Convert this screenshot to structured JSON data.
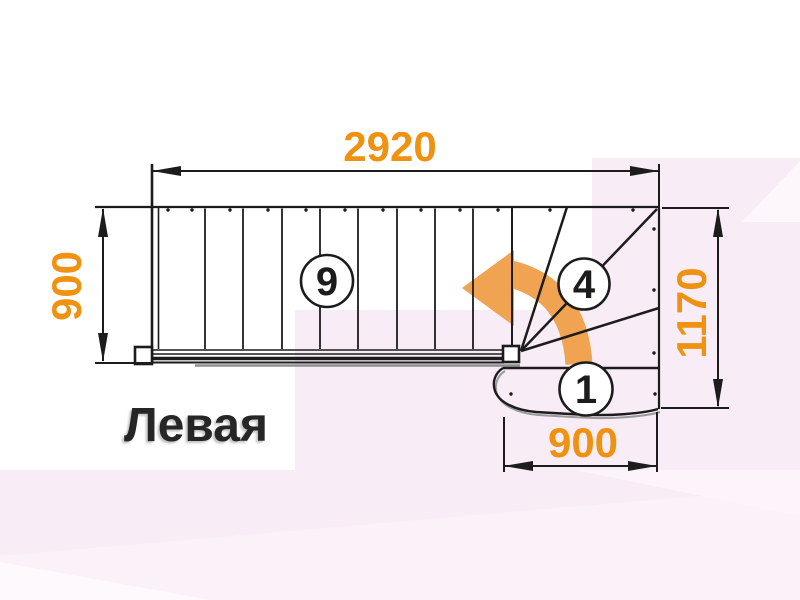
{
  "diagram": {
    "orientation_label": "Левая",
    "dimensions": {
      "top_width": "2920",
      "left_height": "900",
      "right_height": "1170",
      "bottom_width": "900"
    },
    "step_labels": {
      "straight_steps": "9",
      "winder_step": "4",
      "first_step": "1"
    },
    "colors": {
      "dimension_text": "#EF9211",
      "arrow_fill": "#F0A351",
      "line_color": "#1C1C1C",
      "background_pink": "#F8ECF6"
    }
  }
}
